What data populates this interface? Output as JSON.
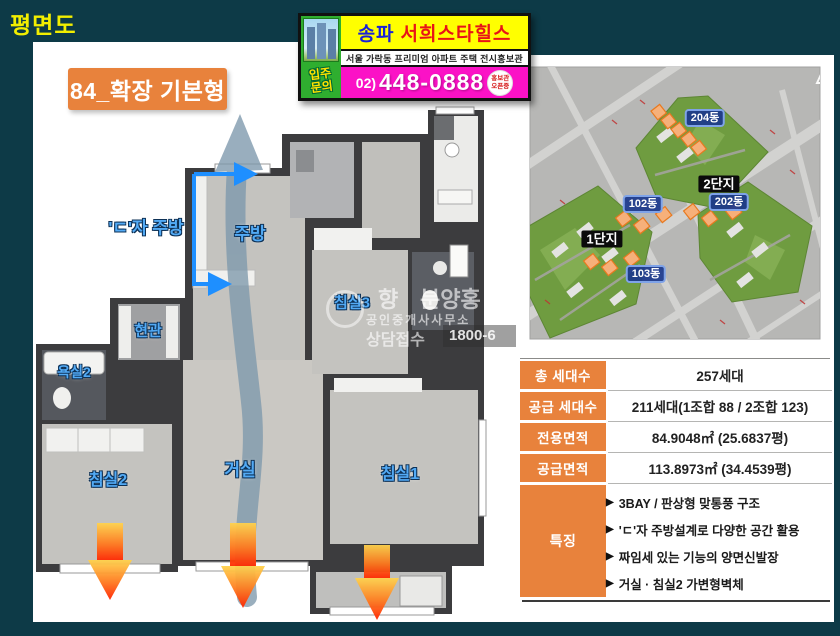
{
  "page": {
    "title": "평면도"
  },
  "banner": {
    "brand_prefix": "송파",
    "brand_name": "서희스타힐스",
    "subtitle": "서울 가락동 프리미엄 아파트 주택 전시홍보관",
    "phone_prefix": "02)",
    "phone_number": "448-0888",
    "inquiry_line1": "입주",
    "inquiry_line2": "문의",
    "badge_line1": "홍보관",
    "badge_line2": "오픈중"
  },
  "floorplan": {
    "type_label": "84_확장 기본형",
    "labels": {
      "kitchen_note": "'ㄷ'자 주방",
      "kitchen": "주방",
      "entrance": "현관",
      "bathroom2": "욕실2",
      "bedroom3": "침실3",
      "bedroom2": "침실2",
      "living": "거실",
      "bedroom1": "침실1"
    },
    "watermark": {
      "char1": "향",
      "brand": "분양홍",
      "office": "공인중개사사무소",
      "contact_label": "상담접수",
      "contact_number": "1800-6"
    }
  },
  "sitemap": {
    "building_204": "204동",
    "complex_2": "2단지",
    "building_202": "202동",
    "building_102": "102동",
    "complex_1": "1단지",
    "building_103": "103동"
  },
  "info_table": {
    "rows": [
      {
        "label": "총 세대수",
        "value": "257세대"
      },
      {
        "label": "공급 세대수",
        "value": "211세대(1조합 88 / 2조합 123)"
      },
      {
        "label": "전용면적",
        "value": "84.9048㎡ (25.6837평)"
      },
      {
        "label": "공급면적",
        "value": "113.8973㎡ (34.4539평)"
      }
    ],
    "features_label": "특징",
    "bullet_glyph": "▶",
    "features": [
      "3BAY / 판상형 맞통풍 구조",
      "'ㄷ'자 주방설계로 다양한 공간 활용",
      "짜임세 있는 기능의 양면신발장",
      "거실 · 침실2 가변형벽체"
    ]
  },
  "colors": {
    "background_teal": "#0d3a47",
    "accent_orange": "#e8823c",
    "title_yellow": "#f2ee00",
    "banner_magenta": "#fb12c6",
    "room_label_blue": "#52aaf5"
  }
}
